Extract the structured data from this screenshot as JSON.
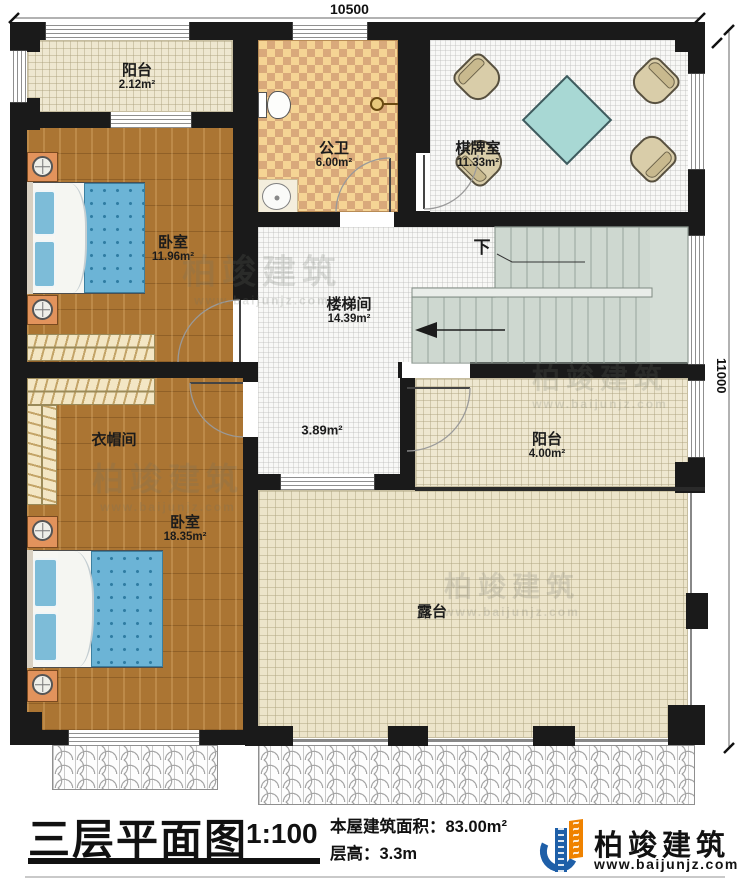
{
  "dimensions": {
    "top": "10500",
    "right": "11000"
  },
  "rooms": {
    "balcony_top": {
      "name": "阳台",
      "area": "2.12m²"
    },
    "bedroom_top": {
      "name": "卧室",
      "area": "11.96m²"
    },
    "bathroom": {
      "name": "公卫",
      "area": "6.00m²"
    },
    "chess_room": {
      "name": "棋牌室",
      "area": "11.33m²"
    },
    "stairwell": {
      "name": "楼梯间",
      "area": "14.39m²"
    },
    "cloakroom": {
      "name": "衣帽间"
    },
    "bedroom_bottom": {
      "name": "卧室",
      "area": "18.35m²"
    },
    "balcony_right": {
      "name": "阳台",
      "area": "4.00m²"
    },
    "terrace": {
      "name": "露台"
    },
    "hall_area": "3.89m²",
    "stairs_down": "下"
  },
  "footer": {
    "title": "三层平面图",
    "scale": "1:100",
    "area_line": "本屋建筑面积：83.00m²",
    "height_line": "层高：3.3m"
  },
  "brand": {
    "name": "柏竣建筑",
    "url": "www.baijunjz.com"
  },
  "watermark": {
    "name": "柏竣建筑",
    "url": "www.baijunjz.com"
  },
  "colors": {
    "wall": "#1a1a1a",
    "wood_floor": "#ab7533",
    "checker_light": "#f5d494",
    "checker_dark": "#d9a97b",
    "stair_floor": "#ced8d0",
    "bed_blue": "#6cb4d6",
    "table_teal": "#a8d8d4",
    "logo_blue": "#1e5fa8",
    "logo_orange": "#ef8200"
  }
}
